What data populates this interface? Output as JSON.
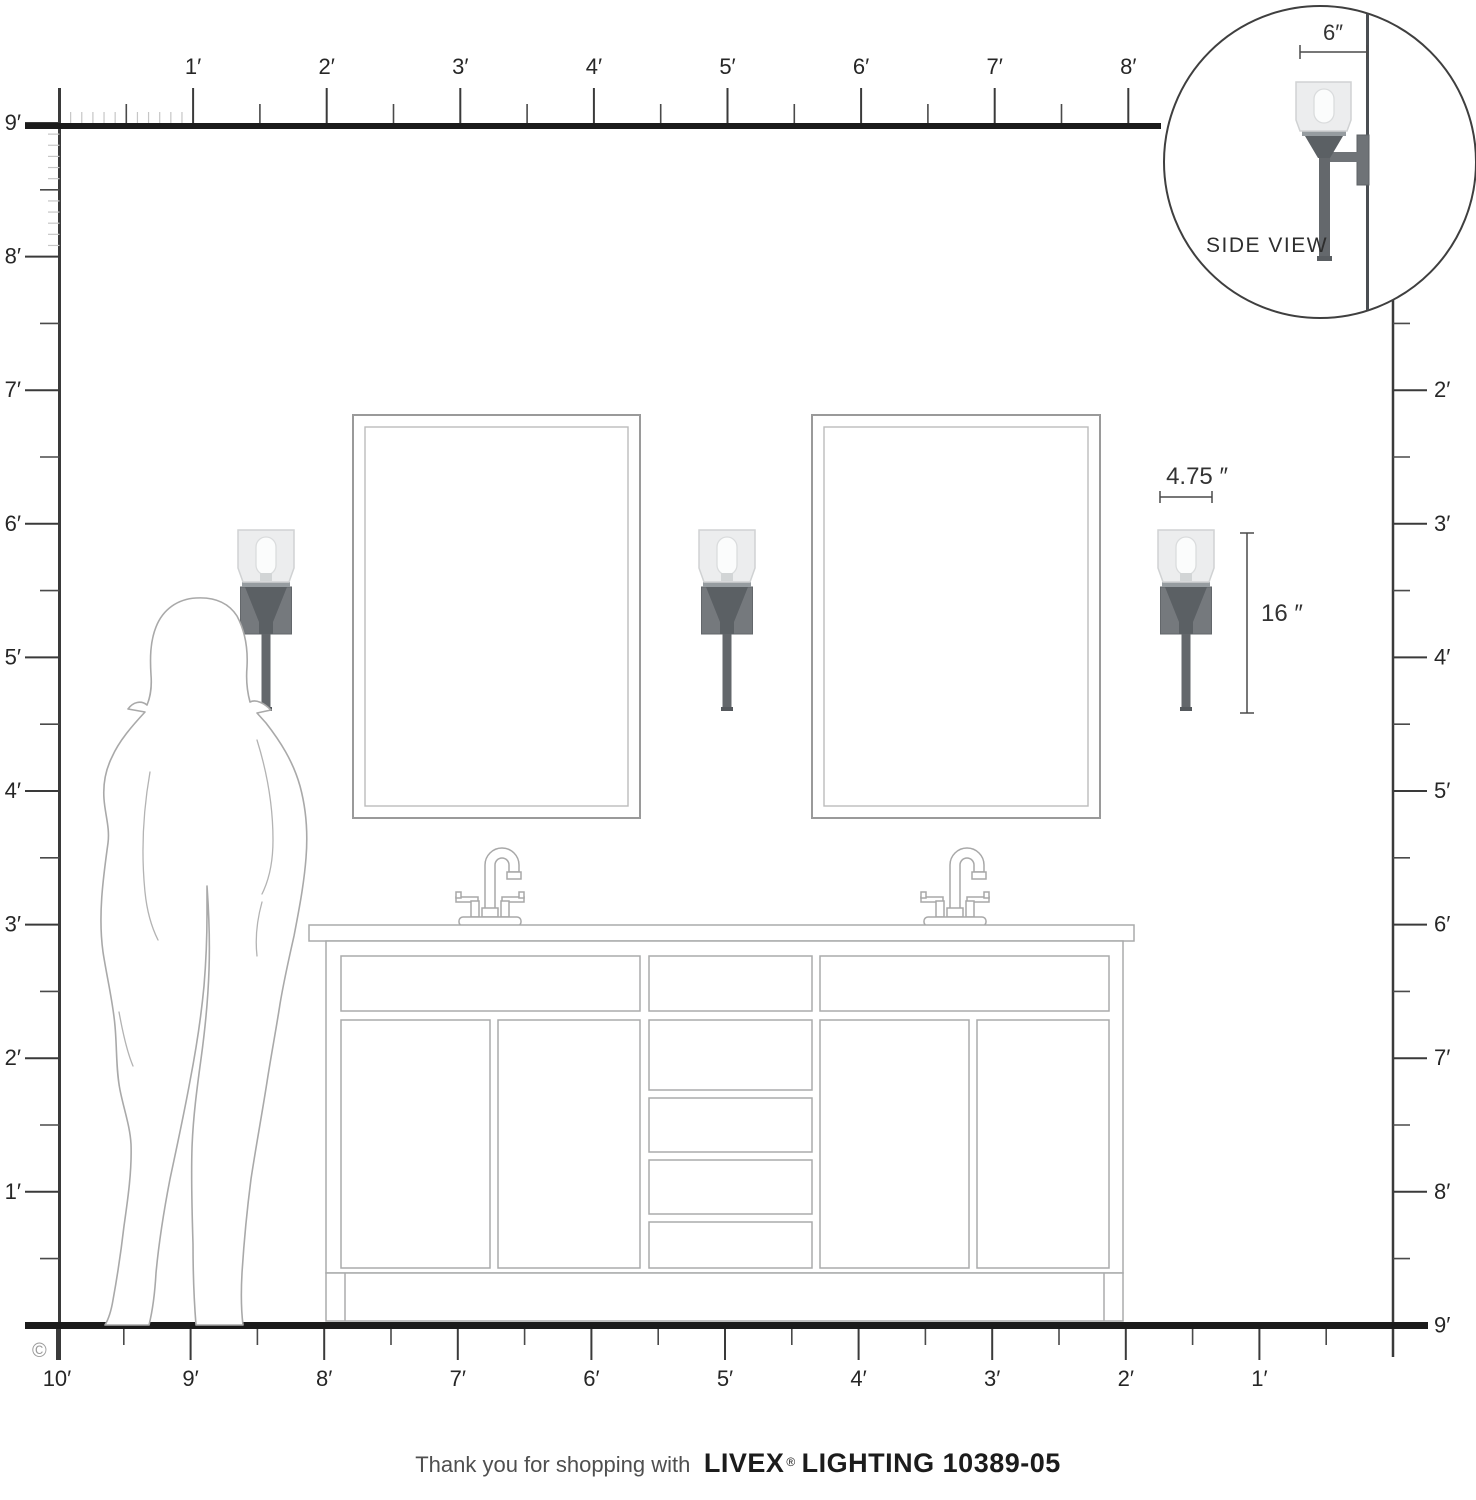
{
  "product": {
    "footer_prefix": "Thank you for shopping with",
    "brand": "LIVEX",
    "registered_mark": "®",
    "footer_product": "LIGHTING 10389-05"
  },
  "copyright_symbol": "©",
  "side_view": {
    "label": "SIDE VIEW",
    "depth_dimension": "6″"
  },
  "dimensions": {
    "shade_width": "4.75 ″",
    "fixture_height": "16 ″"
  },
  "rulers": {
    "top": {
      "labels": [
        "1′",
        "2′",
        "3′",
        "4′",
        "5′",
        "6′",
        "7′",
        "8′"
      ]
    },
    "left": {
      "labels": [
        "9′",
        "8′",
        "7′",
        "6′",
        "5′",
        "4′",
        "3′",
        "2′",
        "1′"
      ]
    },
    "right": {
      "labels": [
        "2′",
        "3′",
        "4′",
        "5′",
        "6′",
        "7′",
        "8′",
        "9′"
      ]
    },
    "bottom": {
      "labels": [
        "10′",
        "9′",
        "8′",
        "7′",
        "6′",
        "5′",
        "4′",
        "3′",
        "2′",
        "1′"
      ]
    }
  },
  "colors": {
    "line_black": "#1b1b1b",
    "outline_gray": "#a9a9a9",
    "metal_gray": "#6f7377",
    "funnel_gray": "#5b6064",
    "glass_gray": "#ecedee"
  }
}
